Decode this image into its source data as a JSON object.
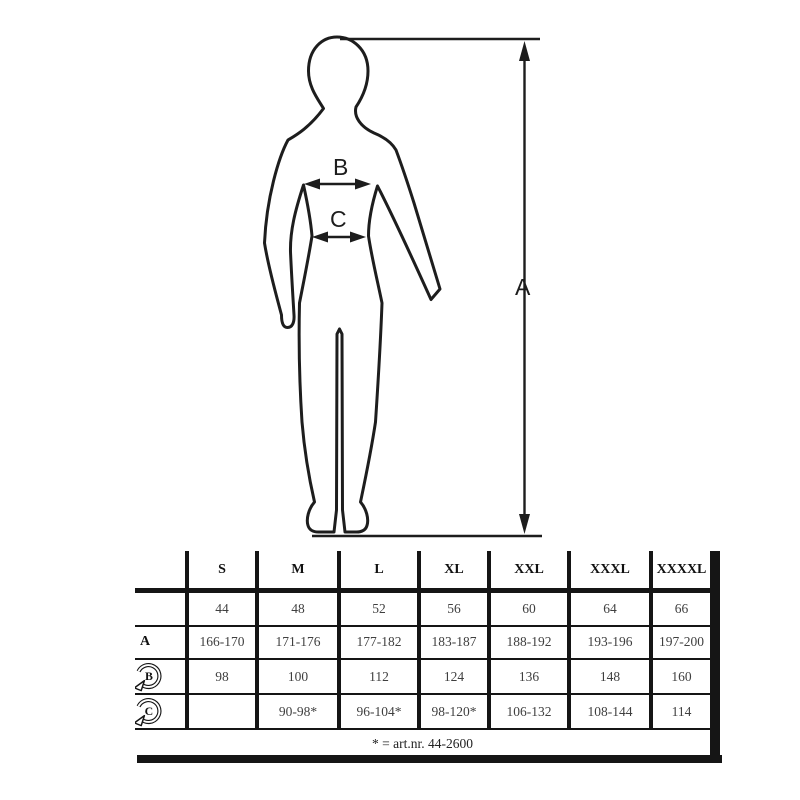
{
  "figure": {
    "height_label": "A",
    "chest_label": "B",
    "waist_label": "C"
  },
  "table": {
    "columns": [
      "S",
      "M",
      "L",
      "XL",
      "XXL",
      "XXXL",
      "XXXXL"
    ],
    "rows": [
      {
        "label": "",
        "icon": "",
        "cells": [
          "44",
          "48",
          "52",
          "56",
          "60",
          "64",
          "66"
        ]
      },
      {
        "label": "A",
        "icon": "",
        "cells": [
          "166-170",
          "171-176",
          "177-182",
          "183-187",
          "188-192",
          "193-196",
          "197-200"
        ]
      },
      {
        "label": "B",
        "icon": "circular-arrow-icon",
        "cells": [
          "98",
          "100",
          "112",
          "124",
          "136",
          "148",
          "160"
        ]
      },
      {
        "label": "C",
        "icon": "circular-arrow-icon",
        "cells": [
          "",
          "90-98*",
          "96-104*",
          "98-120*",
          "106-132",
          "108-144",
          "114"
        ]
      }
    ],
    "footnote": "* = art.nr. 44-2600"
  },
  "colors": {
    "line": "#151515",
    "table_text": "#3f3f3f",
    "background": "#ffffff"
  }
}
